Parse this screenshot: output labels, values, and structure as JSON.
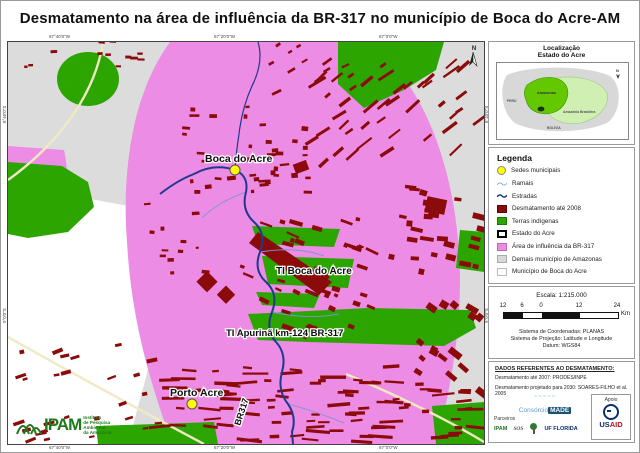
{
  "title": "Desmatamento na área de influência da BR-317 no município de Boca do Acre-AM",
  "map": {
    "labels": {
      "boca_do_acre": "Boca do Acre",
      "ti_boca_do_acre": "TI Boca do Acre",
      "ti_apurina": "TI Apurinã km-124 BR-317",
      "porto_acre": "Porto Acre",
      "road": "BR317"
    },
    "north_label": "N",
    "coords": {
      "top": [
        "67°40'0\"W",
        "67°20'0\"W",
        "67°0'0\"W"
      ],
      "bottom": [
        "67°40'0\"W",
        "67°20'0\"W",
        "67°0'0\"W"
      ],
      "left": [
        "8°40'0\"S",
        "9°0'0\"S"
      ],
      "right": [
        "8°40'0\"S",
        "9°0'0\"S"
      ]
    }
  },
  "locator": {
    "title_line1": "Localização",
    "title_line2": "Estado do Acre",
    "north_label": "N",
    "labels": {
      "peru": "PERU",
      "amazonas": "Amazonas",
      "amazonia_brasileira": "Amazônia Brasileira",
      "bolivia": "BOLÍVIA"
    }
  },
  "legend": {
    "title": "Legenda",
    "items": [
      {
        "label": "Sedes municipais",
        "swatch": "yellow-circle",
        "color": "#FFFF00"
      },
      {
        "label": "Ramais",
        "swatch": "thin-blue-line",
        "color": "#7396CF"
      },
      {
        "label": "Estradas",
        "swatch": "thick-blue-line",
        "color": "#1E3A8F"
      },
      {
        "label": "Desmatamento até 2008",
        "swatch": "square",
        "color": "#8B0A0A"
      },
      {
        "label": "Terras indígenas",
        "swatch": "square",
        "color": "#2CA500"
      },
      {
        "label": "Estado do Acre",
        "swatch": "black-outline-square",
        "color": "#000000"
      },
      {
        "label": "Área de influência da BR-317",
        "swatch": "square",
        "color": "#EC8CE4"
      },
      {
        "label": "Demais município de Amazonas",
        "swatch": "square",
        "color": "#D9D9D9"
      },
      {
        "label": "Município de Boca do Acre",
        "swatch": "square",
        "color": "#FFFFFF"
      }
    ]
  },
  "scale": {
    "escala": "Escala: 1:215.000",
    "ticks": [
      "12",
      "6",
      "0",
      "12",
      "24"
    ],
    "unit": "Km",
    "lines": [
      "Sistema de Coordenadas: PLANAS",
      "Sistema de Projeção: Latitude e Longitude",
      "Datum: WGS84"
    ]
  },
  "dados": {
    "header": "DADOS REFERENTES AO DESMATAMENTO:",
    "lines": [
      "Desmatamento até 2007: PRODES/INPE",
      "Desmatamento projetado para 2030: SOARES-FILHO et al. 2005"
    ]
  },
  "credits": {
    "consorcio_prefix": "Consórcio",
    "consorcio_suffix": "MADE",
    "apoio_label": "Apoio",
    "usaid_part1": "US",
    "usaid_part2": "AID",
    "parceiros_label": "Parceiros",
    "partner_ipam": "IPAM",
    "partner_sos": "SOS",
    "partner_uf": "UF FLORIDA"
  },
  "ipam_logo": {
    "acronym": "IPAM",
    "line1": "Instituto",
    "line2": "de Pesquisa",
    "line3": "Ambiental",
    "line4": "da Amazônia"
  },
  "colors": {
    "influence_area_pink": "#EC8CE4",
    "indigenous_green": "#2CA500",
    "deforestation_red": "#8B0A0A",
    "other_municipalities_gray": "#DCDCDC",
    "boca_do_acre_white": "#FFFFFF",
    "road_blue": "#1E3A8F",
    "ramal_blue": "#7396CF",
    "state_boundary_pale": "#F0EAC4",
    "city_dot_yellow": "#FFFF00"
  }
}
